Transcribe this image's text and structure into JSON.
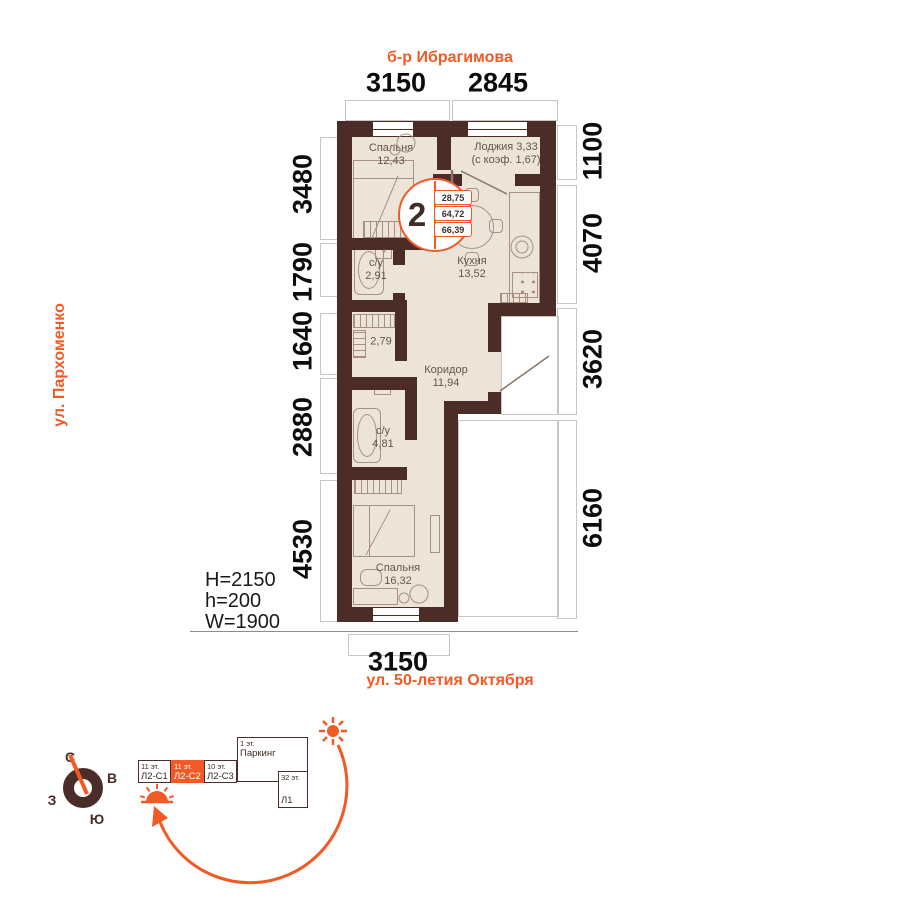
{
  "colors": {
    "accent": "#f15a24",
    "wall": "#4b2c27",
    "floor": "#ece4d8",
    "furniture": "#a8907e",
    "room_label": "#64564b",
    "dim_text": "#0c0c0c",
    "outline": "#c6c6c6"
  },
  "streets": {
    "top": "б-р Ибрагимова",
    "left": "ул. Пархоменко",
    "bottom": "ул. 50-летия Октября"
  },
  "dims": {
    "top": [
      "3150",
      "2845"
    ],
    "bottom": [
      "3150"
    ],
    "left": [
      "3480",
      "1790",
      "1640",
      "2880",
      "4530"
    ],
    "right": [
      "1100",
      "4070",
      "3620",
      "6160"
    ]
  },
  "rooms": {
    "bedroom1": {
      "line1": "Спальня",
      "line2": "12,43"
    },
    "loggia": {
      "line1": "Лоджия 3,33",
      "line2": "(с коэф. 1,67)"
    },
    "kitchen": {
      "line1": "Кухня",
      "line2": "13,52"
    },
    "bath1": {
      "line1": "с/у",
      "line2": "2,91"
    },
    "wardrobe": {
      "line2": "2,79"
    },
    "corridor": {
      "line1": "Коридор",
      "line2": "11,94"
    },
    "bath2": {
      "line1": "с/у",
      "line2": "4,81"
    },
    "bedroom2": {
      "line1": "Спальня",
      "line2": "16,32"
    }
  },
  "badge": {
    "rooms_count": "2",
    "areas": [
      "28,75",
      "64,72",
      "66,39"
    ]
  },
  "specs": [
    "H=2150",
    "h=200",
    "W=1900"
  ],
  "compass": {
    "north": "С",
    "east": "В",
    "south": "Ю",
    "west": "З"
  },
  "buildings": {
    "blocks": [
      {
        "floors": "11 эт.",
        "name": "Л2-С1",
        "active": false
      },
      {
        "floors": "11 эт.",
        "name": "Л2-С2",
        "active": true
      },
      {
        "floors": "10 эт.",
        "name": "Л2-С3",
        "active": false
      }
    ],
    "parking": {
      "floors": "1 эт.",
      "name": "Паркинг"
    },
    "tower": {
      "floors": "32 эт.",
      "name": "Л1"
    }
  }
}
